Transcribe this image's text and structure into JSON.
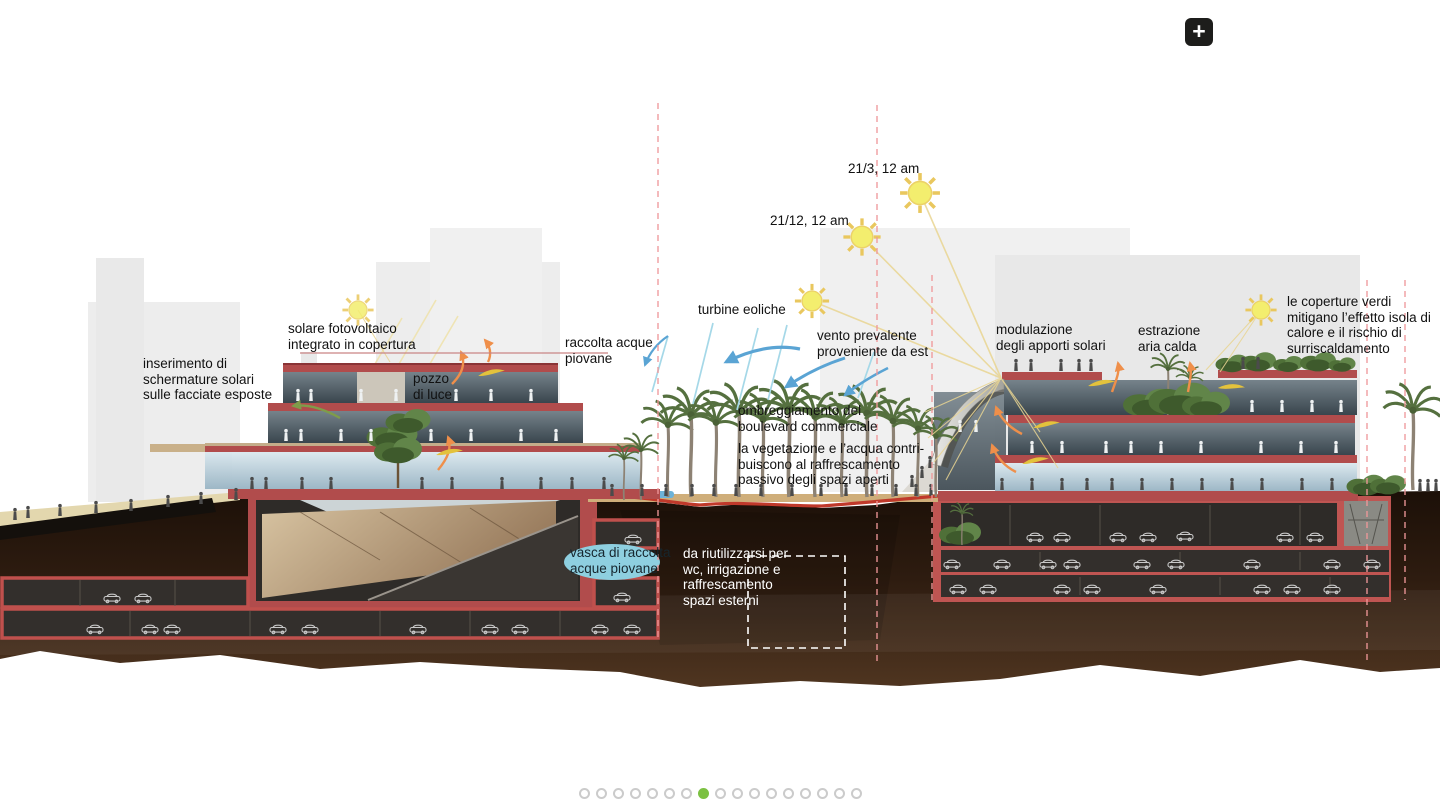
{
  "page": {
    "background": "#ffffff"
  },
  "toolbar": {
    "zoom_button_label": "+"
  },
  "carousel": {
    "total": 17,
    "active_index": 7
  },
  "palette": {
    "accent_green": "#7cc142",
    "section_red": "#b14c4c",
    "frame_red": "#c0504d",
    "earth_brown": "#2e1c10",
    "sun_yellow": "#f3ee6e",
    "wind_blue": "#5aa4d4",
    "water_blue": "#8ecfe0",
    "dashed_pink": "#f2a0a0"
  },
  "diagram": {
    "labels": {
      "schermature": {
        "text": "inserimento di\nschermature solari\nsulle facciate esposte"
      },
      "solare": {
        "text": "solare fotovoltaico\nintegrato in copertura"
      },
      "pozzo": {
        "text": "pozzo\ndi luce"
      },
      "raccolta": {
        "text": "raccolta acque\npiovane"
      },
      "turbine": {
        "text": "turbine eoliche"
      },
      "vento": {
        "text": "vento prevalente\nproveniente da est"
      },
      "ombreggiamento": {
        "text": "ombreggiamento del\nboulevard commerciale"
      },
      "vegetazione": {
        "text": "la vegetazione e l’acqua contri-\nbuiscono al raffrescamento\npassivo degli spazi aperti"
      },
      "modulazione": {
        "text": "modulazione\ndegli apporti solari"
      },
      "estrazione": {
        "text": "estrazione\naria calda"
      },
      "coperture": {
        "text": "le coperture verdi\nmitigano l’effetto isola di\ncalore e il rischio di\nsurriscaldamento"
      },
      "vasca": {
        "text": "vasca di raccolta\nacque piovane"
      },
      "riutilizzo": {
        "text": "da riutilizzarsi per\nwc, irrigazione e\nraffrescamento\nspazi esterni"
      },
      "sun_march": {
        "text": "21/3, 12 am"
      },
      "sun_december": {
        "text": "21/12, 12 am"
      }
    }
  }
}
